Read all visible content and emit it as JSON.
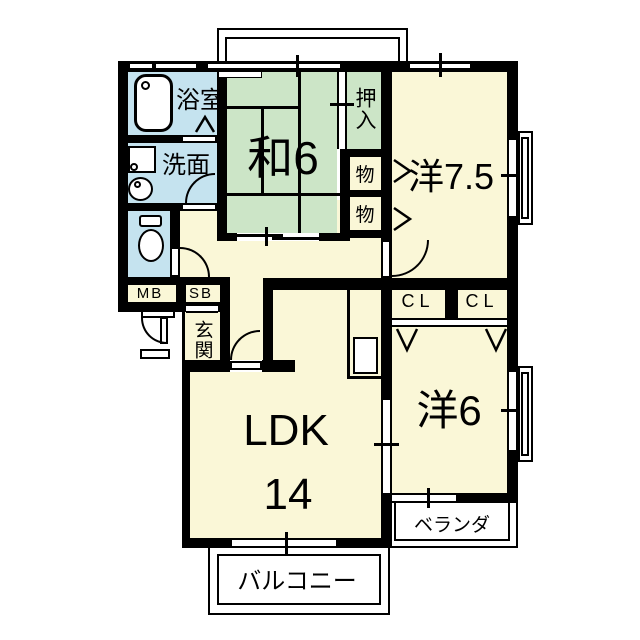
{
  "plan_type": "apartment-floorplan",
  "rooms": {
    "bathroom": {
      "label": "浴室"
    },
    "washroom": {
      "label": "洗面"
    },
    "japanese_room": {
      "label": "和6"
    },
    "oshiire": {
      "label": "押入"
    },
    "storage1": {
      "label": "物"
    },
    "storage2": {
      "label": "物"
    },
    "western75": {
      "label": "洋7.5"
    },
    "closet1": {
      "label": "CL"
    },
    "closet2": {
      "label": "CL"
    },
    "western6": {
      "label": "洋6"
    },
    "ldk": {
      "label": "LDK",
      "size": "14"
    },
    "meter_box": {
      "label": "MB"
    },
    "shaft_box": {
      "label": "SB"
    },
    "entrance": {
      "label": "玄関"
    },
    "veranda": {
      "label": "ベランダ"
    },
    "balcony": {
      "label": "バルコニー"
    }
  },
  "fixtures": [
    "bathtub",
    "washing-machine",
    "sink",
    "toilet",
    "kitchen-counter"
  ],
  "colors": {
    "room_yellow": "#FAF7D7",
    "room_green": "#CCE5C7",
    "room_blue": "#C5E3EF",
    "wall": "#000000",
    "background": "#FFFFFF"
  }
}
